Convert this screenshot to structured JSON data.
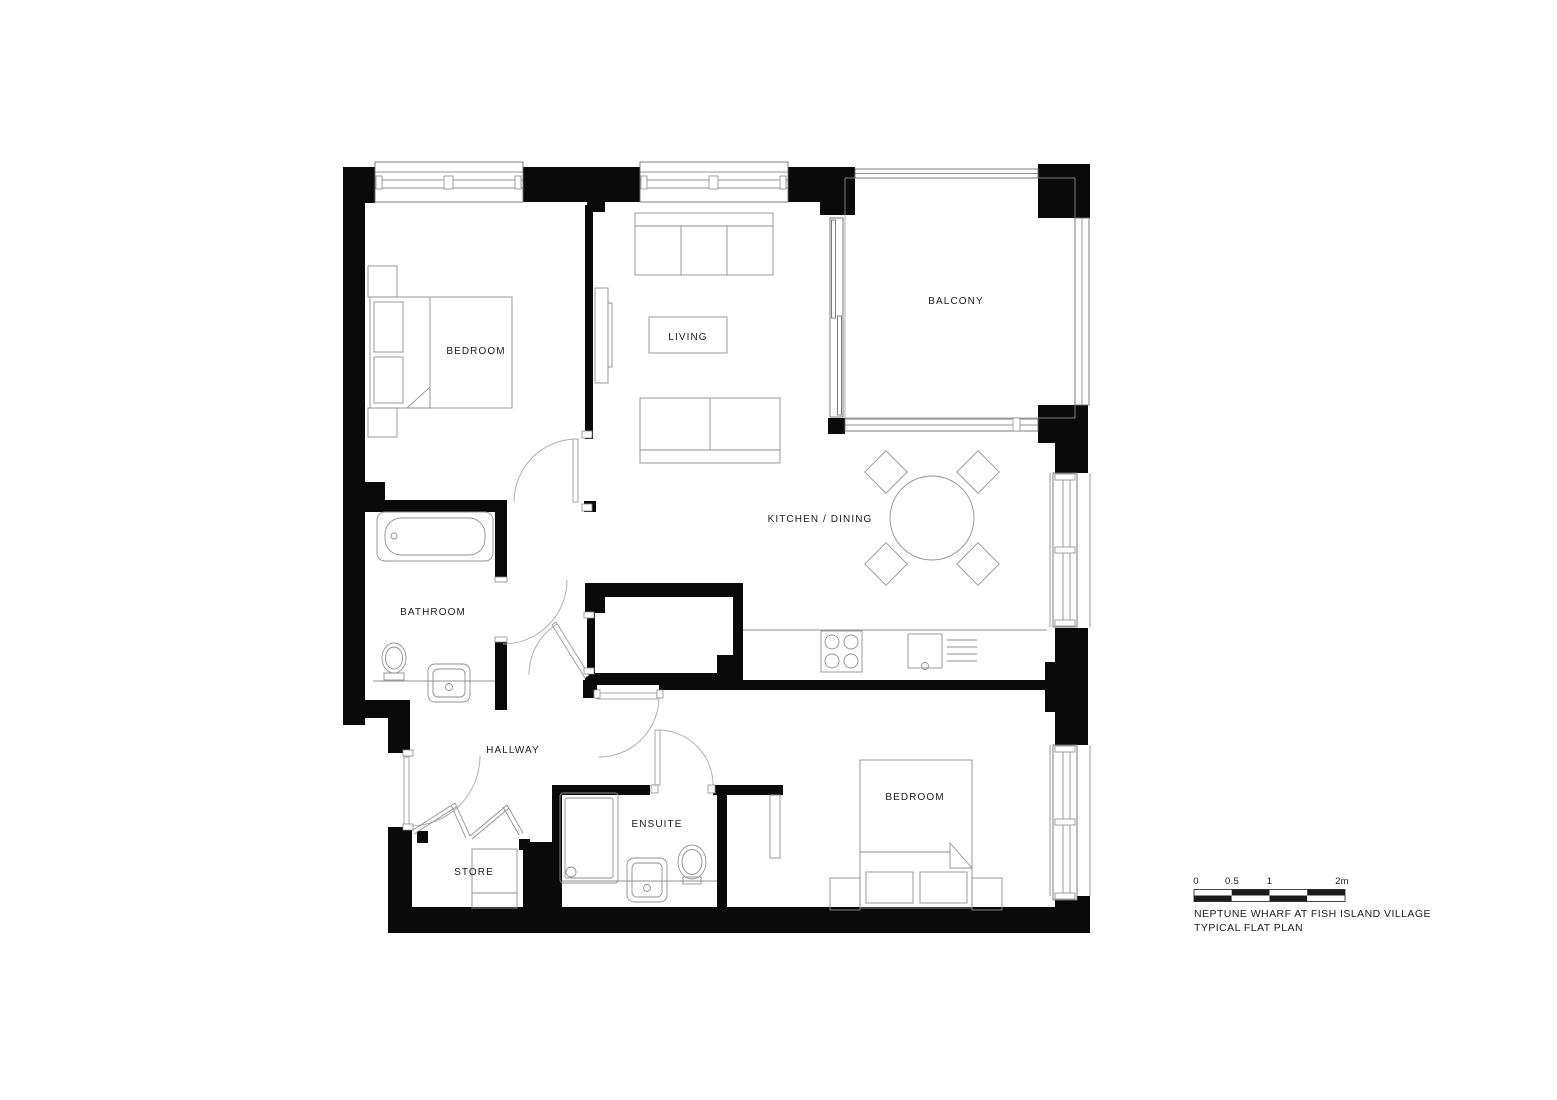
{
  "plan": {
    "rooms": [
      {
        "id": "bedroom-1",
        "label": "BEDROOM"
      },
      {
        "id": "living",
        "label": "LIVING"
      },
      {
        "id": "balcony",
        "label": "BALCONY"
      },
      {
        "id": "kitchen-dining",
        "label": "KITCHEN / DINING"
      },
      {
        "id": "bathroom",
        "label": "BATHROOM"
      },
      {
        "id": "hallway",
        "label": "HALLWAY"
      },
      {
        "id": "store",
        "label": "STORE"
      },
      {
        "id": "ensuite",
        "label": "ENSUITE"
      },
      {
        "id": "bedroom-2",
        "label": "BEDROOM"
      }
    ]
  },
  "scale_bar": {
    "ticks": [
      "0",
      "0.5",
      "1",
      "2m"
    ],
    "unit": "m"
  },
  "title": {
    "line1": "NEPTUNE WHARF AT FISH ISLAND VILLAGE",
    "line2": "TYPICAL FLAT PLAN"
  },
  "colors": {
    "background": "#ffffff",
    "wall": "#0a0a0a",
    "furniture_line": "#8f8f8f",
    "window_line": "#6f6f6f",
    "door_arc": "#a9a9a9",
    "deck_stripe": "#cfcfcf",
    "label_text": "#1b1b1b"
  }
}
